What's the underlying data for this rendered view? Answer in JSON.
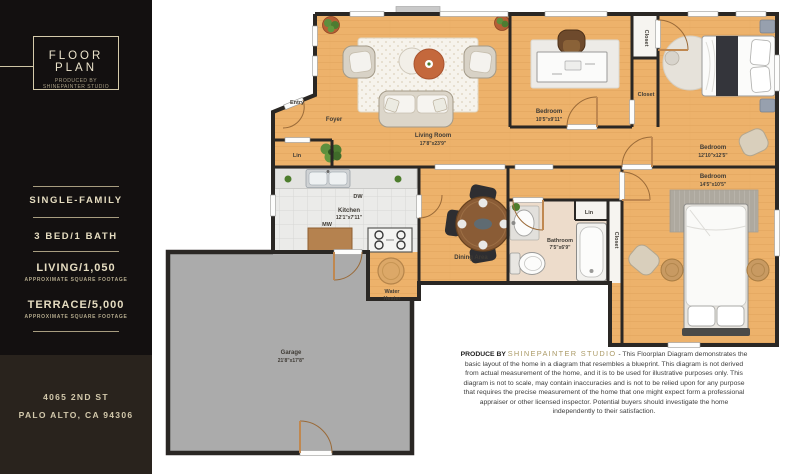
{
  "sidebar": {
    "badge_title": "FLOOR PLAN",
    "badge_subtitle": "PRODUCED BY SHINEPAINTER STUDIO",
    "property_type": "SINGLE-FAMILY",
    "bed_bath": "3 BED/1 BATH",
    "living_label": "LIVING/1,050",
    "living_sublabel": "APPROXIMATE SQUARE FOOTAGE",
    "terrace_label": "TERRACE/5,000",
    "terrace_sublabel": "APPROXIMATE SQUARE FOOTAGE",
    "address_line1": "4065 2ND ST",
    "address_line2": "PALO ALTO, CA 94306"
  },
  "plan": {
    "entry": "Entry",
    "foyer": "Foyer",
    "lin_foyer": "Lin",
    "lin_bath": "Lin",
    "living_name": "Living Room",
    "living_dims": "17'8\"x23'9\"",
    "bedroom1_name": "Bedroom",
    "bedroom1_dims": "10'5\"x9'11\"",
    "bedroom2_name": "Bedroom",
    "bedroom2_dims": "12'10\"x12'5\"",
    "bedroom3_name": "Bedroom",
    "bedroom3_dims": "14'5\"x10'5\"",
    "kitchen_name": "Kitchen",
    "kitchen_dims": "12'1\"x7'11\"",
    "dining": "Dining Area",
    "bathroom_name": "Bathroom",
    "bathroom_dims": "7'5\"x6'9\"",
    "garage_name": "Garage",
    "garage_dims": "21'8\"x17'8\"",
    "water_heater_line1": "Water",
    "water_heater_line2": "Heater",
    "closet_a": "Closet",
    "closet_b": "Closet",
    "closet_c": "Closet",
    "dw": "DW",
    "mw": "MW"
  },
  "disclaimer": {
    "prefix": "PRODUCE BY ",
    "brand": "SHINEPAINTER STUDIO",
    "body": " - This Floorplan Diagram demonstrates the basic layout of the home in a diagram that resembles a blueprint. This diagram is not derived from actual measurement of the home, and it is to be used for illustrative purposes only. This diagram is not to scale, may contain inaccuracies and is not to be relied upon for any purpose that requires the precise measurement of the home that one might expect form a professional appraiser or other licensed inspector. Potential buyers should investigate the home independently to their satisfaction."
  },
  "colors": {
    "wood": "#edb26b",
    "wall": "#2a2724",
    "garage_floor": "#ababab",
    "tile": "#ebebe9",
    "bath_floor": "#eddccb",
    "sidebar_bg": "#131010",
    "sidebar_bg_bottom": "#29231d",
    "cream": "#d9cfb2",
    "gold": "#ab9a66"
  }
}
